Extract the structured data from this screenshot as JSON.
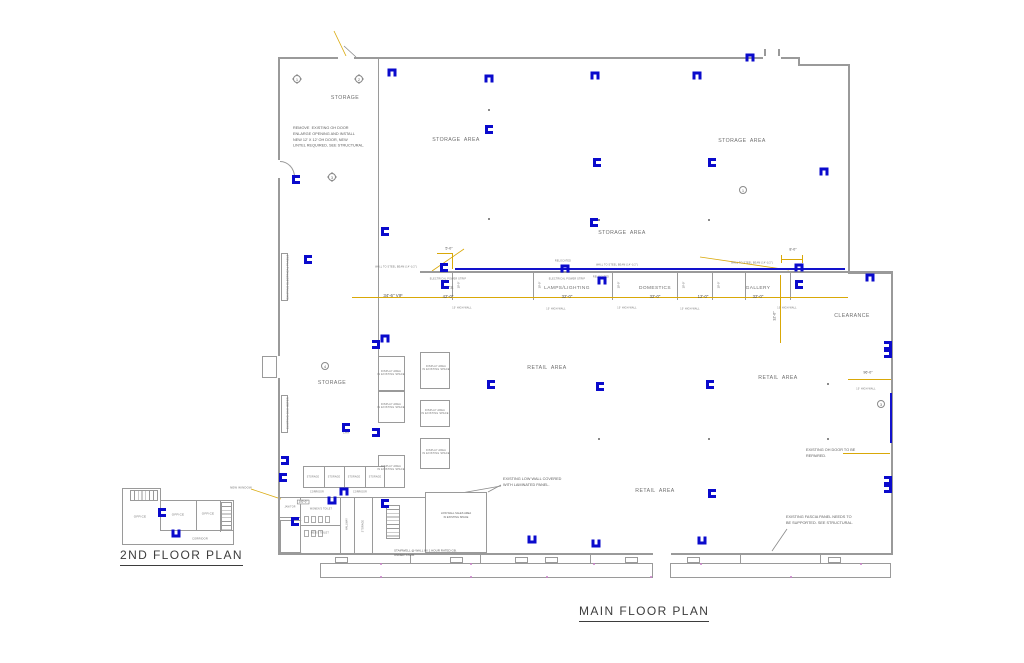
{
  "titles": {
    "main_floor_plan": "MAIN  FLOOR  PLAN",
    "second_floor_plan": "2ND  FLOOR  PLAN"
  },
  "colors": {
    "wall_gray": "#9a9a9a",
    "fixture_blue": "#0a0acc",
    "dimension_yellow": "#d9a808",
    "storefront_pink": "#c87ec8",
    "text_gray": "#6e6e6e"
  },
  "area_labels": [
    {
      "text": "STORAGE",
      "x": 345,
      "y": 98
    },
    {
      "text": "STORAGE  AREA",
      "x": 456,
      "y": 140
    },
    {
      "text": "STORAGE  AREA",
      "x": 742,
      "y": 141
    },
    {
      "text": "STORAGE  AREA",
      "x": 622,
      "y": 233
    },
    {
      "text": "STORAGE",
      "x": 332,
      "y": 383
    },
    {
      "text": "RETAIL  AREA",
      "x": 547,
      "y": 368
    },
    {
      "text": "RETAIL  AREA",
      "x": 778,
      "y": 378
    },
    {
      "text": "RETAIL  AREA",
      "x": 655,
      "y": 491
    },
    {
      "text": "CLEARANCE",
      "x": 852,
      "y": 316
    }
  ],
  "departments": [
    {
      "name": "TV'S",
      "width": "42'-0\"",
      "x": 448
    },
    {
      "name": "LAMPS/LIGHTING",
      "width": "32'-0\"",
      "x": 567
    },
    {
      "name": "DOMESTICS",
      "width": "32'-0\"",
      "x": 655
    },
    {
      "name": "",
      "width": "12'-0\"",
      "x": 703
    },
    {
      "name": "GALLERY",
      "width": "32'-0\"",
      "x": 758
    }
  ],
  "dim_labels": [
    {
      "text": "34'-6\" VIF",
      "x": 393,
      "y": 296,
      "s": 4.4
    },
    {
      "text": "5'-0\"",
      "x": 449,
      "y": 249,
      "s": 3.6
    },
    {
      "text": "8'-0\"",
      "x": 793,
      "y": 250,
      "s": 3.6
    },
    {
      "text": "96'-0\"",
      "x": 868,
      "y": 373,
      "s": 3.6
    },
    {
      "text": "32'-0\"",
      "x": 775,
      "y": 316,
      "rot": -90,
      "s": 3.6
    },
    {
      "text": "10'-0\"",
      "x": 459,
      "y": 285,
      "rot": -90,
      "s": 2.6
    },
    {
      "text": "10'-0\"",
      "x": 540,
      "y": 285,
      "rot": -90,
      "s": 2.6
    },
    {
      "text": "10'-0\"",
      "x": 619,
      "y": 285,
      "rot": -90,
      "s": 2.6
    },
    {
      "text": "10'-0\"",
      "x": 684,
      "y": 285,
      "rot": -90,
      "s": 2.6
    },
    {
      "text": "10'-0\"",
      "x": 719,
      "y": 285,
      "rot": -90,
      "s": 2.6
    },
    {
      "text": "10'-0\"",
      "x": 797,
      "y": 285,
      "rot": -90,
      "s": 2.6
    },
    {
      "text": "100'-0\"",
      "x": 303,
      "y": 502,
      "s": 2.8,
      "boxed": true
    }
  ],
  "small_labels": [
    {
      "text": "ELECTRICAL POWER STRIP",
      "x": 448,
      "y": 279,
      "s": 2.4
    },
    {
      "text": "ELECTRICAL POWER STRIP",
      "x": 567,
      "y": 279,
      "s": 2.4
    },
    {
      "text": "10' HIGH WALL",
      "x": 462,
      "y": 308,
      "s": 2.4
    },
    {
      "text": "10' HIGH WALL",
      "x": 556,
      "y": 309,
      "s": 2.4
    },
    {
      "text": "10' HIGH WALL",
      "x": 627,
      "y": 308,
      "s": 2.4
    },
    {
      "text": "10' HIGH WALL",
      "x": 690,
      "y": 309,
      "s": 2.4
    },
    {
      "text": "10' HIGH WALL",
      "x": 787,
      "y": 308,
      "s": 2.4
    },
    {
      "text": "10' HIGH WALL",
      "x": 866,
      "y": 389,
      "s": 2.4
    },
    {
      "text": "WALL TO STEEL BEAM (14'-1/2\")",
      "x": 396,
      "y": 267,
      "s": 2.4
    },
    {
      "text": "WALL TO STEEL BEAM (14'-1/2\")",
      "x": 617,
      "y": 265,
      "s": 2.4
    },
    {
      "text": "WALL TO STEEL BEAM (14'-1/2\")",
      "x": 752,
      "y": 263,
      "s": 2.4
    },
    {
      "text": "RELOCATED",
      "x": 563,
      "y": 261,
      "s": 2.4
    },
    {
      "text": "RELOCATED",
      "x": 601,
      "y": 277,
      "s": 2.4
    },
    {
      "text": "NEW WINDOW",
      "x": 241,
      "y": 488,
      "s": 2.8
    },
    {
      "text": "CHA",
      "x": 346,
      "y": 433,
      "s": 2.8
    }
  ],
  "display_labels": [
    {
      "text": "DISPLAY AREA\nIN EXISTING SPACE",
      "x": 391,
      "y": 373
    },
    {
      "text": "DISPLAY AREA\nIN EXISTING SPACE",
      "x": 391,
      "y": 406
    },
    {
      "text": "DISPLAY AREA\nIN EXISTING SPACE",
      "x": 391,
      "y": 468
    },
    {
      "text": "DISPLAY AREA\nIN EXISTING SPACE",
      "x": 436,
      "y": 368
    },
    {
      "text": "DISPLAY AREA\nIN EXISTING SPACE",
      "x": 435,
      "y": 412
    },
    {
      "text": "DISPLAY AREA\nIN EXISTING SPACE",
      "x": 436,
      "y": 452
    }
  ],
  "vertical_labels": [
    {
      "text": "EXISTING ELECTRICAL PANELS",
      "x": 288,
      "y": 277
    },
    {
      "text": "EXISTING GAS METER",
      "x": 288,
      "y": 413
    }
  ],
  "notes": [
    {
      "text": "REMOVE  EXISTING OH DOOR\nENLARGE OPENING AND INSTALL\nNEW 12' X 12' OH DOOR, NEW\nLINTEL REQUIRED, SEE STRUCTURAL.",
      "x": 293,
      "y": 126
    },
    {
      "text": "EXISTING LOW WALL COVERED\nWITH LAMINATED PANEL.",
      "x": 503,
      "y": 477
    },
    {
      "text": "EXISTING OH DOOR TO BE\nREPAIRED.",
      "x": 806,
      "y": 448
    },
    {
      "text": "EXISTING FASCIA PANEL NEEDS TO\nBE SUPPORTED. SEE STRUCTURAL.",
      "x": 786,
      "y": 515
    },
    {
      "text": "STAIRWELL @ WALL W/ 1 HOUR RATED GB.\nUNDER STAIR.",
      "x": 394,
      "y": 549,
      "s": 3
    },
    {
      "text": "LOW WALL SALES AREA\nIN EXISTING SPACE",
      "x": 456,
      "y": 516,
      "center": true,
      "s": 2.6
    }
  ],
  "room_labels": [
    {
      "text": "OFFICE",
      "x": 140,
      "y": 517,
      "s": 3
    },
    {
      "text": "OFFICE",
      "x": 178,
      "y": 515,
      "s": 3
    },
    {
      "text": "OFFICE",
      "x": 208,
      "y": 514,
      "s": 3
    },
    {
      "text": "CORRIDOR",
      "x": 200,
      "y": 539,
      "s": 2.6
    },
    {
      "text": "STORAGE",
      "x": 313,
      "y": 477,
      "s": 2.3
    },
    {
      "text": "STORAGE",
      "x": 334,
      "y": 477,
      "s": 2.3
    },
    {
      "text": "STORAGE",
      "x": 354,
      "y": 477,
      "s": 2.3
    },
    {
      "text": "STORAGE",
      "x": 375,
      "y": 477,
      "s": 2.3
    },
    {
      "text": "CORRIDOR",
      "x": 317,
      "y": 492,
      "s": 2.3
    },
    {
      "text": "CORRIDOR",
      "x": 360,
      "y": 492,
      "s": 2.3
    },
    {
      "text": "JANITOR",
      "x": 290,
      "y": 507,
      "s": 2.3
    },
    {
      "text": "WOMEN'S TOILET",
      "x": 321,
      "y": 509,
      "s": 2.3
    },
    {
      "text": "MEN'S TOILET",
      "x": 320,
      "y": 533,
      "s": 2.3
    },
    {
      "text": "HALLWAY",
      "x": 347,
      "y": 524,
      "rot": -90,
      "s": 2.3
    },
    {
      "text": "STORAGE",
      "x": 363,
      "y": 526,
      "rot": -90,
      "s": 2.3
    }
  ],
  "fixture_icon": "wall-mounted-light-fixture",
  "fixtures": [
    [
      388,
      68,
      90
    ],
    [
      485,
      74,
      90
    ],
    [
      591,
      71,
      90
    ],
    [
      693,
      71,
      90
    ],
    [
      746,
      53,
      90
    ],
    [
      292,
      175,
      0
    ],
    [
      304,
      255,
      0
    ],
    [
      381,
      227,
      0
    ],
    [
      485,
      125,
      0
    ],
    [
      593,
      158,
      0
    ],
    [
      708,
      158,
      0
    ],
    [
      590,
      218,
      0
    ],
    [
      440,
      263,
      0
    ],
    [
      441,
      280,
      0
    ],
    [
      561,
      264,
      90
    ],
    [
      598,
      276,
      90
    ],
    [
      795,
      263,
      90
    ],
    [
      795,
      280,
      0
    ],
    [
      866,
      273,
      90
    ],
    [
      820,
      167,
      90
    ],
    [
      372,
      340,
      180
    ],
    [
      381,
      334,
      90
    ],
    [
      342,
      423,
      0
    ],
    [
      372,
      428,
      180
    ],
    [
      281,
      456,
      180
    ],
    [
      279,
      473,
      0
    ],
    [
      340,
      487,
      90
    ],
    [
      328,
      496,
      270
    ],
    [
      381,
      499,
      0
    ],
    [
      291,
      517,
      0
    ],
    [
      487,
      380,
      0
    ],
    [
      596,
      382,
      0
    ],
    [
      706,
      380,
      0
    ],
    [
      708,
      489,
      0
    ],
    [
      528,
      535,
      270
    ],
    [
      592,
      539,
      270
    ],
    [
      698,
      536,
      270
    ],
    [
      884,
      341,
      180
    ],
    [
      884,
      349,
      180
    ],
    [
      884,
      476,
      180
    ],
    [
      884,
      484,
      180
    ],
    [
      158,
      508,
      0
    ],
    [
      172,
      529,
      270
    ]
  ],
  "bubbles": [
    {
      "n": "1",
      "x": 297,
      "y": 79,
      "d": true
    },
    {
      "n": "2",
      "x": 359,
      "y": 79,
      "d": true
    },
    {
      "n": "3",
      "x": 332,
      "y": 177,
      "d": true
    },
    {
      "n": "4",
      "x": 325,
      "y": 366
    },
    {
      "n": "1",
      "x": 743,
      "y": 190
    },
    {
      "n": "3",
      "x": 881,
      "y": 404
    }
  ],
  "column_dots": [
    [
      488,
      109
    ],
    [
      488,
      218
    ],
    [
      598,
      219
    ],
    [
      708,
      219
    ],
    [
      598,
      438
    ],
    [
      708,
      438
    ],
    [
      827,
      438
    ],
    [
      827,
      383
    ]
  ],
  "storefront": {
    "windows": [
      335,
      450,
      515,
      545,
      625,
      687,
      828
    ],
    "pink_dots": [
      [
        380,
        563
      ],
      [
        380,
        576
      ],
      [
        470,
        563
      ],
      [
        470,
        576
      ],
      [
        546,
        576
      ],
      [
        593,
        563
      ],
      [
        650,
        576
      ],
      [
        700,
        563
      ],
      [
        790,
        576
      ],
      [
        860,
        563
      ]
    ]
  }
}
